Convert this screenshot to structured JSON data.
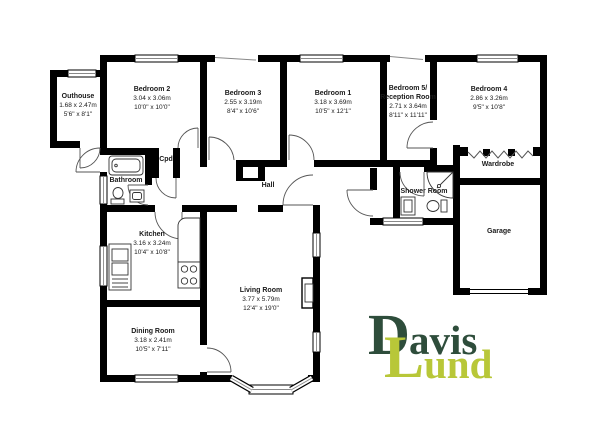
{
  "floorplan": {
    "wall_color": "#000000",
    "rooms": {
      "outhouse": {
        "name": "Outhouse",
        "metric": "1.68 x 2.47m",
        "imperial": "5'6\" x 8'1\""
      },
      "bedroom2": {
        "name": "Bedroom 2",
        "metric": "3.04 x 3.06m",
        "imperial": "10'0\" x 10'0\""
      },
      "bedroom3": {
        "name": "Bedroom 3",
        "metric": "2.55 x 3.19m",
        "imperial": "8'4\" x 10'6\""
      },
      "bedroom1": {
        "name": "Bedroom 1",
        "metric": "3.18 x 3.69m",
        "imperial": "10'5\" x 12'1\""
      },
      "bedroom5": {
        "name_line1": "Bedroom 5/",
        "name_line2": "Reception Room",
        "metric": "2.71 x 3.64m",
        "imperial": "8'11\" x 11'11\""
      },
      "bedroom4": {
        "name": "Bedroom 4",
        "metric": "2.86 x 3.26m",
        "imperial": "9'5\" x 10'8\""
      },
      "kitchen": {
        "name": "Kitchen",
        "metric": "3.16 x 3.24m",
        "imperial": "10'4\" x 10'8\""
      },
      "dining_room": {
        "name": "Dining Room",
        "metric": "3.18 x 2.41m",
        "imperial": "10'5\" x 7'11\""
      },
      "living_room": {
        "name": "Living Room",
        "metric": "3.77 x 5.79m",
        "imperial": "12'4\" x 19'0\""
      }
    },
    "areas": {
      "bathroom": "Bathroom",
      "cupboard": "Cpd",
      "hall": "Hall",
      "shower_room": "Shower Room",
      "wardrobe": "Wardrobe",
      "garage": "Garage"
    }
  },
  "logo": {
    "initial_1": "D",
    "rest_1": "avis",
    "initial_2": "L",
    "rest_2": "und",
    "color_primary": "#2e4d3b",
    "color_secondary": "#b8c738"
  }
}
